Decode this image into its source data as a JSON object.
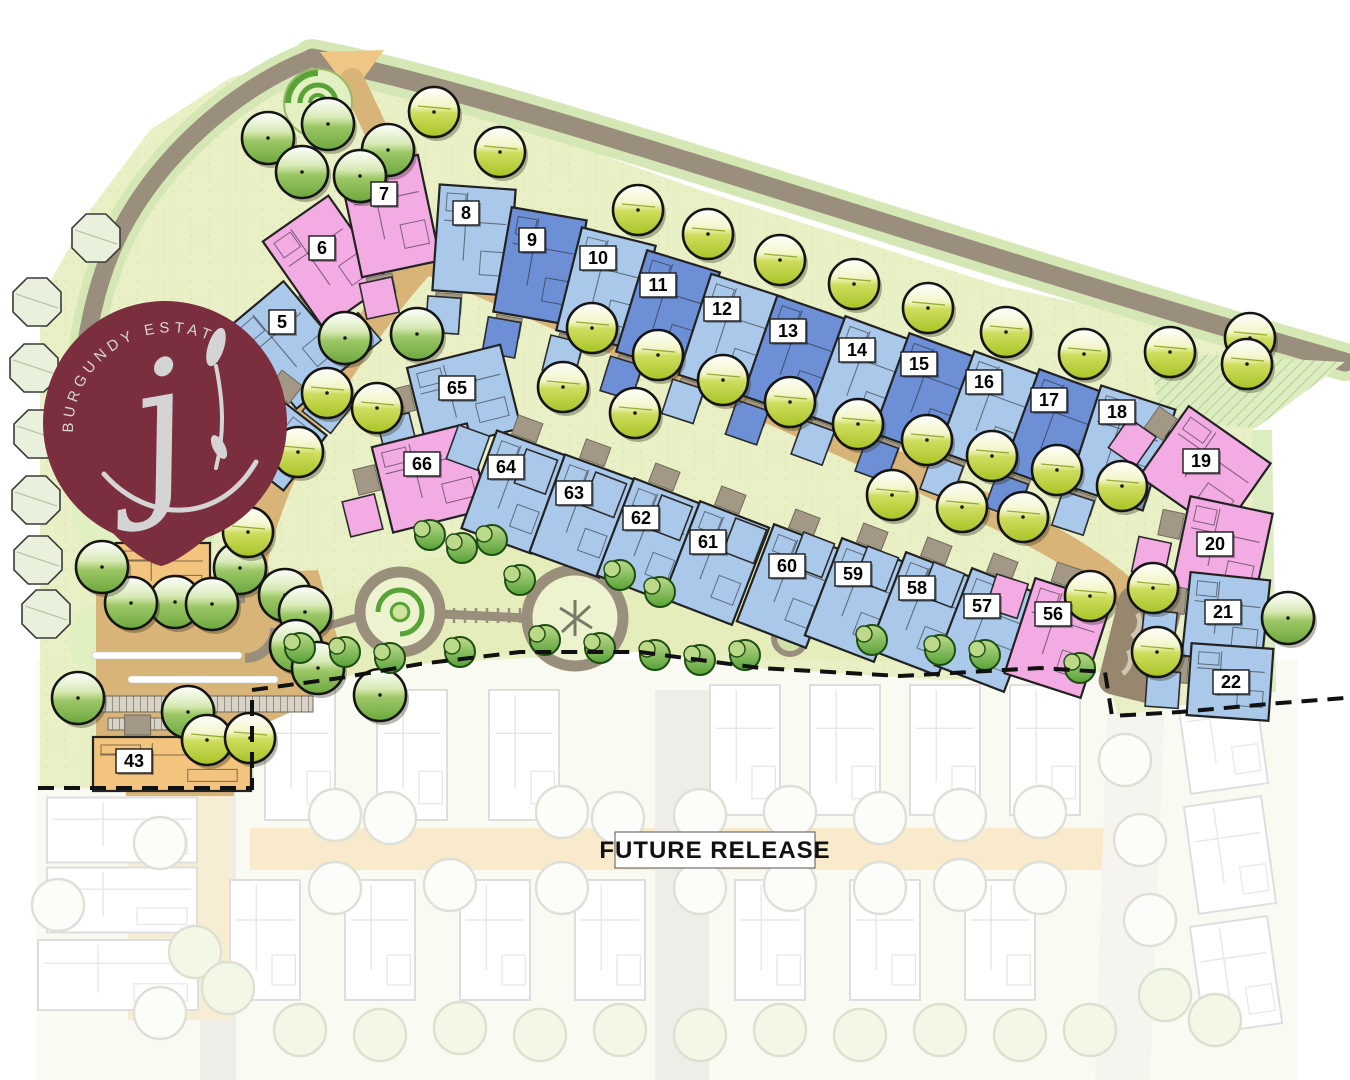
{
  "logo": {
    "name": "BURGUNDY ESTATE",
    "monogram": "j",
    "pin_color": "#7b2e3d",
    "text_color": "#d6d6d6"
  },
  "labels": {
    "future_release": "FUTURE RELEASE"
  },
  "palette": {
    "lawn": "#eaf0c6",
    "park_lawn": "#e4eeb8",
    "road_tan": "#d9b478",
    "road_gray": "#9a8e7c",
    "hedge": "#d5e7b4",
    "lot_blue": "#a9c8ea",
    "lot_blue_dark": "#6d8fd6",
    "lot_pink": "#f2abe3",
    "lot_orange": "#f2c47e",
    "tree_lime": "#b5cc2f",
    "tree_green": "#74ad41",
    "chip_bg": "#ffffff",
    "chip_text": "#000000",
    "boundary_dash": "#111111"
  },
  "lots_format": "id, color(blue|blueD|pink|orange), cx, cy, w, h, rot_deg, label_x, label_y, road_side",
  "lots": [
    [
      "5",
      "blue",
      290,
      345,
      72,
      106,
      -40,
      282,
      322,
      "e"
    ],
    [
      "6",
      "pink",
      326,
      262,
      80,
      106,
      -35,
      322,
      248,
      "s"
    ],
    [
      "7",
      "pink",
      390,
      216,
      80,
      108,
      -12,
      384,
      194,
      "s"
    ],
    [
      "8",
      "blue",
      474,
      240,
      76,
      106,
      4,
      466,
      213,
      "s"
    ],
    [
      "9",
      "blueD",
      540,
      266,
      76,
      106,
      10,
      532,
      240,
      "s"
    ],
    [
      "10",
      "blue",
      606,
      288,
      76,
      106,
      14,
      598,
      258,
      "s"
    ],
    [
      "11",
      "blueD",
      668,
      312,
      76,
      106,
      17,
      658,
      285,
      "s"
    ],
    [
      "12",
      "blue",
      731,
      336,
      76,
      106,
      18,
      722,
      309,
      "s"
    ],
    [
      "13",
      "blueD",
      796,
      358,
      76,
      106,
      19,
      788,
      331,
      "s"
    ],
    [
      "14",
      "blue",
      863,
      379,
      76,
      106,
      20,
      857,
      350,
      "s"
    ],
    [
      "15",
      "blueD",
      927,
      396,
      76,
      106,
      20,
      919,
      364,
      "s"
    ],
    [
      "16",
      "blue",
      992,
      414,
      76,
      106,
      20,
      984,
      382,
      "s"
    ],
    [
      "17",
      "blueD",
      1057,
      432,
      76,
      106,
      20,
      1049,
      400,
      "s"
    ],
    [
      "18",
      "blue",
      1122,
      448,
      78,
      106,
      18,
      1117,
      412,
      "s"
    ],
    [
      "19",
      "pink",
      1205,
      470,
      100,
      86,
      35,
      1201,
      461,
      "w"
    ],
    [
      "20",
      "pink",
      1222,
      550,
      84,
      92,
      12,
      1215,
      544,
      "w"
    ],
    [
      "21",
      "blue",
      1226,
      618,
      80,
      84,
      6,
      1223,
      612,
      "w"
    ],
    [
      "22",
      "blue",
      1230,
      682,
      82,
      72,
      4,
      1231,
      682,
      "w"
    ],
    [
      "65",
      "blue",
      464,
      398,
      96,
      86,
      -14,
      457,
      388,
      "w"
    ],
    [
      "66",
      "pink",
      430,
      478,
      98,
      88,
      -14,
      422,
      464,
      "w"
    ],
    [
      "64",
      "blue",
      514,
      492,
      74,
      104,
      20,
      506,
      467,
      "n"
    ],
    [
      "63",
      "blue",
      582,
      516,
      74,
      104,
      20,
      574,
      493,
      "n"
    ],
    [
      "62",
      "blue",
      650,
      540,
      74,
      104,
      21,
      641,
      518,
      "n"
    ],
    [
      "61",
      "blue",
      716,
      563,
      74,
      104,
      21,
      708,
      542,
      "n"
    ],
    [
      "60",
      "blue",
      790,
      586,
      74,
      104,
      21,
      787,
      566,
      "n"
    ],
    [
      "59",
      "blue",
      858,
      600,
      74,
      104,
      21,
      853,
      574,
      "n"
    ],
    [
      "58",
      "blue",
      922,
      614,
      74,
      104,
      21,
      917,
      588,
      "n"
    ],
    [
      "57",
      "blue",
      988,
      630,
      74,
      104,
      21,
      982,
      606,
      "n"
    ],
    [
      "56",
      "pink",
      1058,
      638,
      80,
      100,
      18,
      1053,
      614,
      "n"
    ],
    [
      "43",
      "orange",
      172,
      764,
      158,
      54,
      0,
      134,
      761,
      "n"
    ],
    [
      "",
      "blue",
      268,
      434,
      70,
      94,
      -52,
      0,
      0,
      "e"
    ],
    [
      "",
      "orange",
      163,
      570,
      94,
      54,
      0,
      0,
      0,
      ""
    ]
  ],
  "trees": {
    "lime": [
      [
        434,
        112
      ],
      [
        500,
        152
      ],
      [
        638,
        210
      ],
      [
        708,
        234
      ],
      [
        780,
        260
      ],
      [
        854,
        284
      ],
      [
        928,
        308
      ],
      [
        1006,
        332
      ],
      [
        1084,
        354
      ],
      [
        1170,
        352
      ],
      [
        1250,
        338
      ],
      [
        1247,
        364
      ],
      [
        592,
        328
      ],
      [
        658,
        355
      ],
      [
        723,
        380
      ],
      [
        790,
        402
      ],
      [
        858,
        424
      ],
      [
        927,
        440
      ],
      [
        992,
        456
      ],
      [
        1057,
        470
      ],
      [
        1122,
        486
      ],
      [
        563,
        387
      ],
      [
        635,
        413
      ],
      [
        892,
        495
      ],
      [
        962,
        507
      ],
      [
        1023,
        517
      ],
      [
        1090,
        596
      ],
      [
        1153,
        588
      ],
      [
        1157,
        652
      ],
      [
        327,
        393
      ],
      [
        377,
        408
      ],
      [
        298,
        452
      ],
      [
        248,
        532
      ],
      [
        207,
        740
      ],
      [
        250,
        738
      ]
    ],
    "green": [
      [
        268,
        138
      ],
      [
        328,
        124
      ],
      [
        388,
        150
      ],
      [
        302,
        172
      ],
      [
        360,
        176
      ],
      [
        345,
        338
      ],
      [
        417,
        334
      ],
      [
        240,
        568
      ],
      [
        285,
        595
      ],
      [
        175,
        602
      ],
      [
        212,
        604
      ],
      [
        305,
        612
      ],
      [
        296,
        646
      ],
      [
        318,
        668
      ],
      [
        131,
        603
      ],
      [
        102,
        567
      ],
      [
        78,
        698
      ],
      [
        188,
        712
      ],
      [
        380,
        695
      ],
      [
        1288,
        618
      ]
    ],
    "pale": [
      [
        96,
        238
      ],
      [
        37,
        302
      ],
      [
        34,
        368
      ],
      [
        38,
        434
      ],
      [
        36,
        500
      ],
      [
        38,
        560
      ],
      [
        46,
        614
      ]
    ],
    "shrub": [
      [
        300,
        648
      ],
      [
        345,
        652
      ],
      [
        390,
        658
      ],
      [
        460,
        652
      ],
      [
        545,
        640
      ],
      [
        600,
        648
      ],
      [
        655,
        655
      ],
      [
        700,
        660
      ],
      [
        745,
        655
      ],
      [
        520,
        580
      ],
      [
        620,
        575
      ],
      [
        660,
        592
      ],
      [
        430,
        535
      ],
      [
        462,
        548
      ],
      [
        492,
        540
      ],
      [
        872,
        640
      ],
      [
        940,
        650
      ],
      [
        985,
        655
      ],
      [
        1080,
        668
      ]
    ]
  },
  "faded": {
    "opacity": 0.32,
    "houses": [
      {
        "cx": 300,
        "cy": 755,
        "w": 70,
        "h": 130,
        "rot": 0
      },
      {
        "cx": 412,
        "cy": 755,
        "w": 70,
        "h": 130,
        "rot": 0
      },
      {
        "cx": 524,
        "cy": 755,
        "w": 70,
        "h": 130,
        "rot": 0
      },
      {
        "cx": 745,
        "cy": 750,
        "w": 70,
        "h": 130,
        "rot": 0
      },
      {
        "cx": 845,
        "cy": 750,
        "w": 70,
        "h": 130,
        "rot": 0
      },
      {
        "cx": 945,
        "cy": 750,
        "w": 70,
        "h": 130,
        "rot": 0
      },
      {
        "cx": 1045,
        "cy": 750,
        "w": 70,
        "h": 130,
        "rot": 0
      },
      {
        "cx": 265,
        "cy": 940,
        "w": 70,
        "h": 120,
        "rot": 0
      },
      {
        "cx": 380,
        "cy": 940,
        "w": 70,
        "h": 120,
        "rot": 0
      },
      {
        "cx": 495,
        "cy": 940,
        "w": 70,
        "h": 120,
        "rot": 0
      },
      {
        "cx": 610,
        "cy": 940,
        "w": 70,
        "h": 120,
        "rot": 0
      },
      {
        "cx": 770,
        "cy": 940,
        "w": 70,
        "h": 120,
        "rot": 0
      },
      {
        "cx": 885,
        "cy": 940,
        "w": 70,
        "h": 120,
        "rot": 0
      },
      {
        "cx": 1000,
        "cy": 940,
        "w": 70,
        "h": 120,
        "rot": 0
      },
      {
        "cx": 122,
        "cy": 830,
        "w": 150,
        "h": 65,
        "rot": 0
      },
      {
        "cx": 122,
        "cy": 900,
        "w": 150,
        "h": 65,
        "rot": 0
      },
      {
        "cx": 118,
        "cy": 975,
        "w": 160,
        "h": 70,
        "rot": 0
      },
      {
        "cx": 1222,
        "cy": 735,
        "w": 78,
        "h": 108,
        "rot": -8
      },
      {
        "cx": 1230,
        "cy": 855,
        "w": 78,
        "h": 108,
        "rot": -8
      },
      {
        "cx": 1236,
        "cy": 975,
        "w": 78,
        "h": 108,
        "rot": -8
      }
    ],
    "trees": [
      [
        335,
        815
      ],
      [
        390,
        818
      ],
      [
        562,
        812
      ],
      [
        618,
        818
      ],
      [
        700,
        815
      ],
      [
        790,
        812
      ],
      [
        880,
        818
      ],
      [
        960,
        815
      ],
      [
        1040,
        812
      ],
      [
        335,
        888
      ],
      [
        450,
        885
      ],
      [
        562,
        888
      ],
      [
        700,
        888
      ],
      [
        790,
        885
      ],
      [
        880,
        888
      ],
      [
        960,
        885
      ],
      [
        1040,
        888
      ],
      [
        160,
        843
      ],
      [
        160,
        1013
      ],
      [
        1125,
        760
      ],
      [
        1140,
        840
      ],
      [
        1150,
        920
      ],
      [
        58,
        905
      ]
    ],
    "green_trees": [
      [
        300,
        1030
      ],
      [
        380,
        1035
      ],
      [
        460,
        1028
      ],
      [
        540,
        1035
      ],
      [
        620,
        1030
      ],
      [
        700,
        1035
      ],
      [
        780,
        1030
      ],
      [
        860,
        1035
      ],
      [
        940,
        1030
      ],
      [
        1020,
        1035
      ],
      [
        1090,
        1030
      ],
      [
        195,
        952
      ],
      [
        228,
        988
      ],
      [
        1165,
        995
      ],
      [
        1215,
        1020
      ]
    ]
  },
  "roads": {
    "boundary_top": "M 312,58 C 520,98 900,235 1345,362",
    "boundary_left": "M 312,58 C 235,88 160,155 120,232 C 96,280 84,340 80,400 L 80,470",
    "entrance": "M 352,80 C 374,125 402,185 425,258",
    "road_b": "M 425,258 C 600,332 850,442 1010,520 C 1092,560 1148,602 1168,650",
    "road_left": "M 425,258 C 372,315 305,415 276,486 C 260,526 251,556 249,592",
    "court": "M 96,582 L 318,570 L 338,640 L 305,706 L 232,738 L 96,742 Z",
    "vroad": [
      126,
      700,
      108,
      96
    ],
    "markings": [
      [
        92,
        652,
        150,
        7
      ],
      [
        128,
        676,
        150,
        7
      ]
    ],
    "orange_wedge": "M 320,52 L 384,50 L 352,94 Z",
    "dashed_boundary": "38,788 252,788 252,690 340,678 420,664 520,652 640,652 760,668 900,676 1040,668 1105,672 1112,716 1180,712 1280,703 1345,698"
  },
  "park": {
    "circle1": {
      "cx": 400,
      "cy": 612,
      "r": 40
    },
    "circle2": {
      "cx": 575,
      "cy": 618,
      "r": 48
    },
    "small_circle": {
      "cx": 790,
      "cy": 638,
      "r": 16
    },
    "spiral_turn": {
      "cx": 245,
      "cy": 628,
      "r": 30
    },
    "spiral_garden": {
      "cx": 292,
      "cy": 648,
      "r": 22
    },
    "tl_spiral": {
      "cx": 318,
      "cy": 103,
      "r": 30
    },
    "turnaround22": {
      "cx": 1140,
      "cy": 645,
      "w": 64,
      "h": 110,
      "rot": 14
    }
  },
  "hedges": {
    "wedge": "1150,352 1345,362 1256,428 1160,420",
    "strip": "1252,430 1272,430 1276,692 1258,692"
  },
  "parking_rows": [
    [
      98,
      696,
      215,
      16
    ],
    [
      108,
      718,
      105,
      12
    ]
  ],
  "active_area": "312,56 420,90 700,190 1000,286 1345,362 1252,430 1258,588 1262,692 1118,716 1106,672 940,680 760,668 640,652 520,652 420,664 340,678 254,690 254,788 40,788 40,560 40,300 90,210 150,130 230,78",
  "future_band": [
    250,
    828,
    865,
    42
  ],
  "future_box": {
    "x": 615,
    "y": 832,
    "w": 200,
    "h": 36
  }
}
